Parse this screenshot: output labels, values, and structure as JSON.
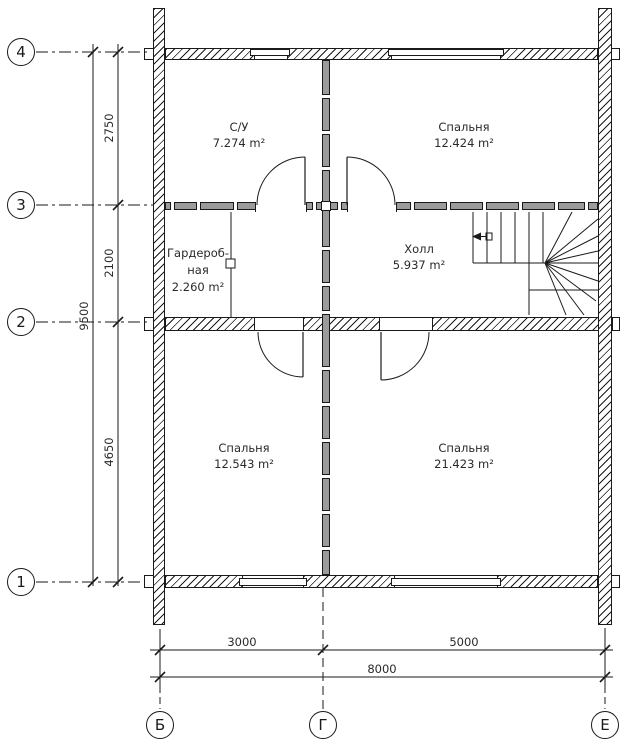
{
  "plan": {
    "title": "floor-plan",
    "axes_h": [
      {
        "label": "4"
      },
      {
        "label": "3"
      },
      {
        "label": "2"
      },
      {
        "label": "1"
      }
    ],
    "axes_v": [
      {
        "label": "Б"
      },
      {
        "label": "Г"
      },
      {
        "label": "Е"
      }
    ],
    "rooms": [
      {
        "name": "С/У",
        "area": "7.274 m²"
      },
      {
        "name": "Спальня",
        "area": "12.424 m²"
      },
      {
        "name_line1": "Гардероб-",
        "name_line2": "ная",
        "area": "2.260 m²"
      },
      {
        "name": "Холл",
        "area": "5.937 m²"
      },
      {
        "name": "Спальня",
        "area": "12.543 m²"
      },
      {
        "name": "Спальня",
        "area": "21.423 m²"
      }
    ],
    "dims": {
      "v_segments": [
        "2750",
        "2100",
        "4650"
      ],
      "v_total": "9500",
      "h_segments": [
        "3000",
        "5000"
      ],
      "h_total": "8000"
    },
    "colors": {
      "line": "#1a1a1a",
      "wall_gray": "#9b9b9b",
      "background": "#ffffff"
    }
  }
}
